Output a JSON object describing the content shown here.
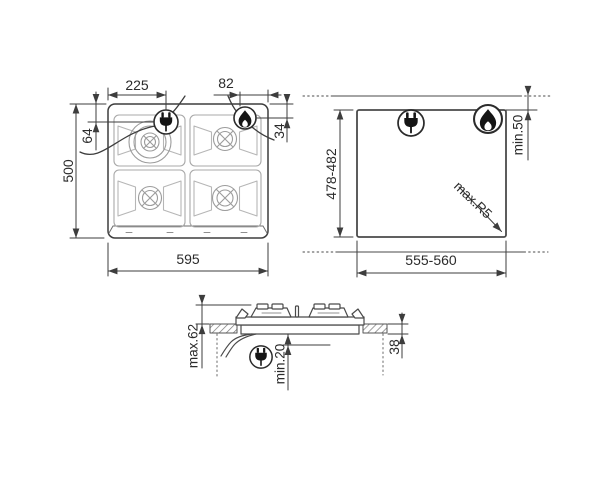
{
  "top_view": {
    "plug_offset_x": "225",
    "flame_offset_x": "82",
    "plug_offset_y": "64",
    "flame_offset_y": "34",
    "depth": "500",
    "width": "595"
  },
  "cutout_view": {
    "depth": "478-482",
    "width": "555-560",
    "rear_clearance": "min.50",
    "corner_radius": "max.R5"
  },
  "section_view": {
    "height_above_worktop": "max.62",
    "clearance_below": "min.20",
    "recess_depth": "38"
  },
  "icons": {
    "plug": "power-plug",
    "flame": "gas-flame"
  },
  "colors": {
    "line": "#3d3d3d",
    "light_line": "#a6a6a6",
    "background": "#ffffff"
  }
}
